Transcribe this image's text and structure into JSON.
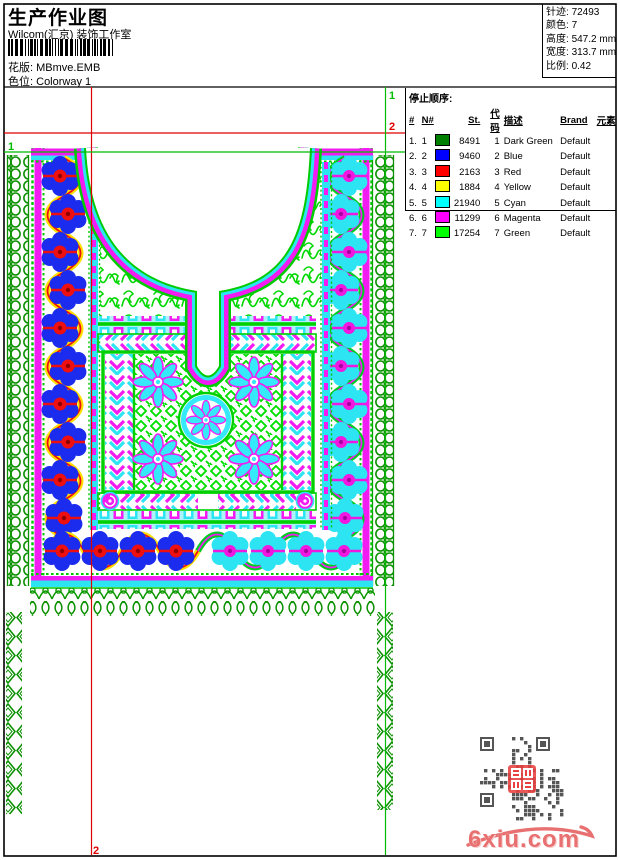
{
  "header": {
    "title": "生产作业图",
    "company": "Wilcom(汇京) 装饰工作室",
    "pattern_label": "花版:",
    "pattern_value": "MBmve.EMB",
    "colorway_label": "色位:",
    "colorway_value": "Colorway 1",
    "stats": [
      {
        "label": "针迹:",
        "value": "72493"
      },
      {
        "label": "颜色:",
        "value": "7"
      },
      {
        "label": "高度:",
        "value": "547.2 mm"
      },
      {
        "label": "宽度:",
        "value": "313.7 mm"
      },
      {
        "label": "比例:",
        "value": "0.42"
      }
    ]
  },
  "color_table": {
    "title": "停止顺序:",
    "columns": [
      "#",
      "N#",
      "St.",
      "代码",
      "描述",
      "Brand",
      "元素"
    ],
    "rows": [
      {
        "num": "1.",
        "n": "1",
        "color": "#008000",
        "st": "8491",
        "code": "1",
        "desc": "Dark Green",
        "brand": "Default",
        "element": ""
      },
      {
        "num": "2.",
        "n": "2",
        "color": "#0000ff",
        "st": "9460",
        "code": "2",
        "desc": "Blue",
        "brand": "Default",
        "element": ""
      },
      {
        "num": "3.",
        "n": "3",
        "color": "#ff0000",
        "st": "2163",
        "code": "3",
        "desc": "Red",
        "brand": "Default",
        "element": ""
      },
      {
        "num": "4.",
        "n": "4",
        "color": "#ffff00",
        "st": "1884",
        "code": "4",
        "desc": "Yellow",
        "brand": "Default",
        "element": ""
      },
      {
        "num": "5.",
        "n": "5",
        "color": "#00ffff",
        "st": "21940",
        "code": "5",
        "desc": "Cyan",
        "brand": "Default",
        "element": ""
      },
      {
        "num": "6.",
        "n": "6",
        "color": "#ff00ff",
        "st": "11299",
        "code": "6",
        "desc": "Magenta",
        "brand": "Default",
        "element": ""
      },
      {
        "num": "7.",
        "n": "7",
        "color": "#00ff00",
        "st": "17254",
        "code": "7",
        "desc": "Green",
        "brand": "Default",
        "element": ""
      }
    ]
  },
  "registration": {
    "mark1": "1",
    "mark2": "2",
    "color1": "#00bb00",
    "color2": "#dd0000"
  },
  "watermark": {
    "site": "6xiu.com",
    "color": "#e87070"
  },
  "design_palette": {
    "dark_green": "#008f00",
    "green": "#00d800",
    "blue": "#1c2cee",
    "red": "#ee1010",
    "yellow": "#ffe000",
    "cyan": "#2de4f2",
    "magenta": "#f21cf2"
  }
}
